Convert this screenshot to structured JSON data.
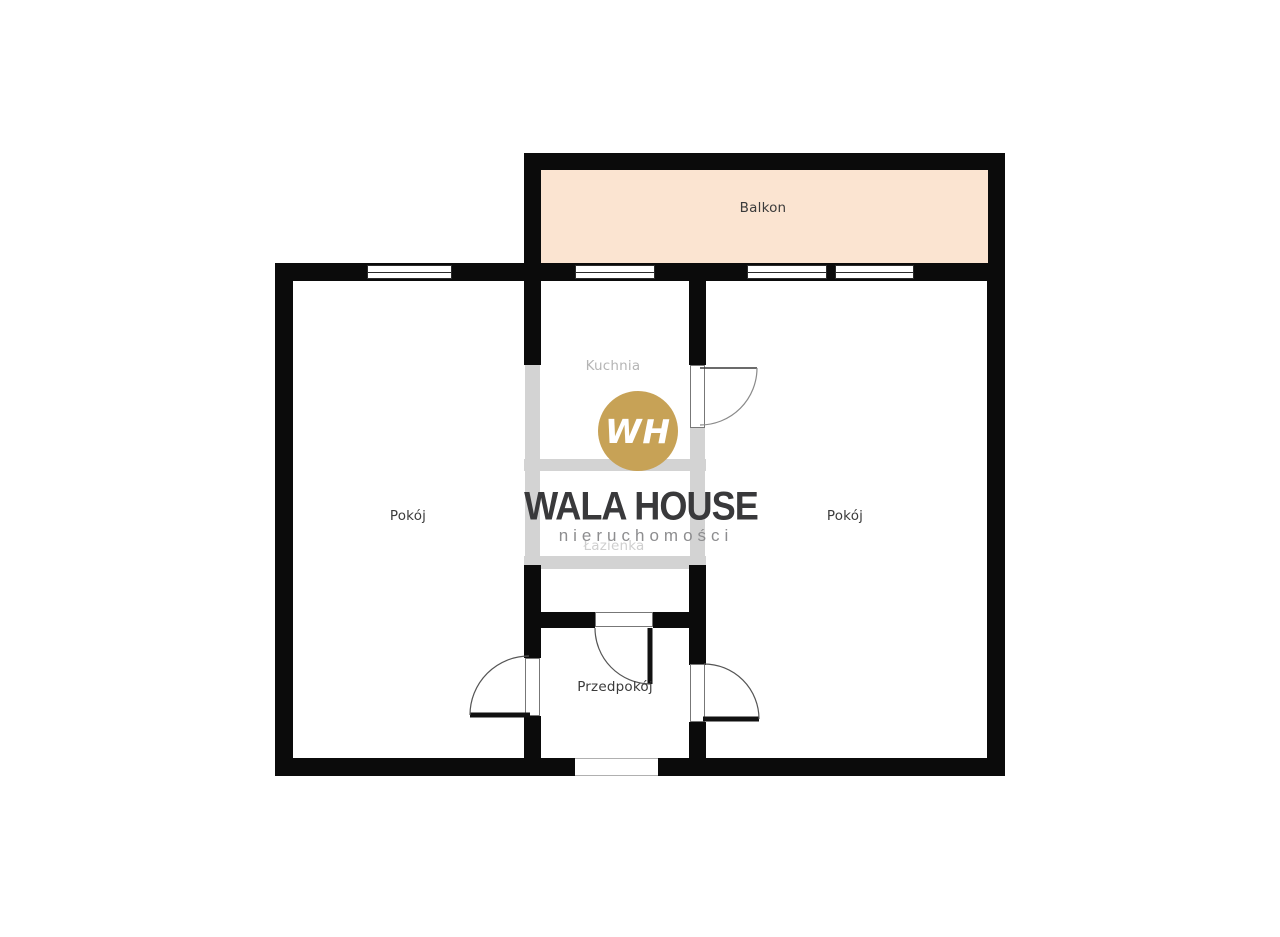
{
  "rooms": {
    "balkon": {
      "label": "Balkon"
    },
    "pokoj_left": {
      "label": "Pokój"
    },
    "kuchnia": {
      "label": "Kuchnia"
    },
    "pokoj_right": {
      "label": "Pokój"
    },
    "lazienka": {
      "label": "Łazienka"
    },
    "przedpokoj": {
      "label": "Przedpokój"
    }
  },
  "brand": {
    "monogram": "WH",
    "name": "WALA HOUSE",
    "tagline": "nieruchomości"
  },
  "colors": {
    "wall": "#0b0b0b",
    "removed_wall": "#d3d3d3",
    "balcony_fill": "#fbe4d1",
    "label_dark": "#3b3b3b",
    "label_muted": "#b5b5b5",
    "watermark_dark": "#39393b",
    "watermark_gray": "#8d8d8f",
    "brand_gold": "#c7a256"
  }
}
